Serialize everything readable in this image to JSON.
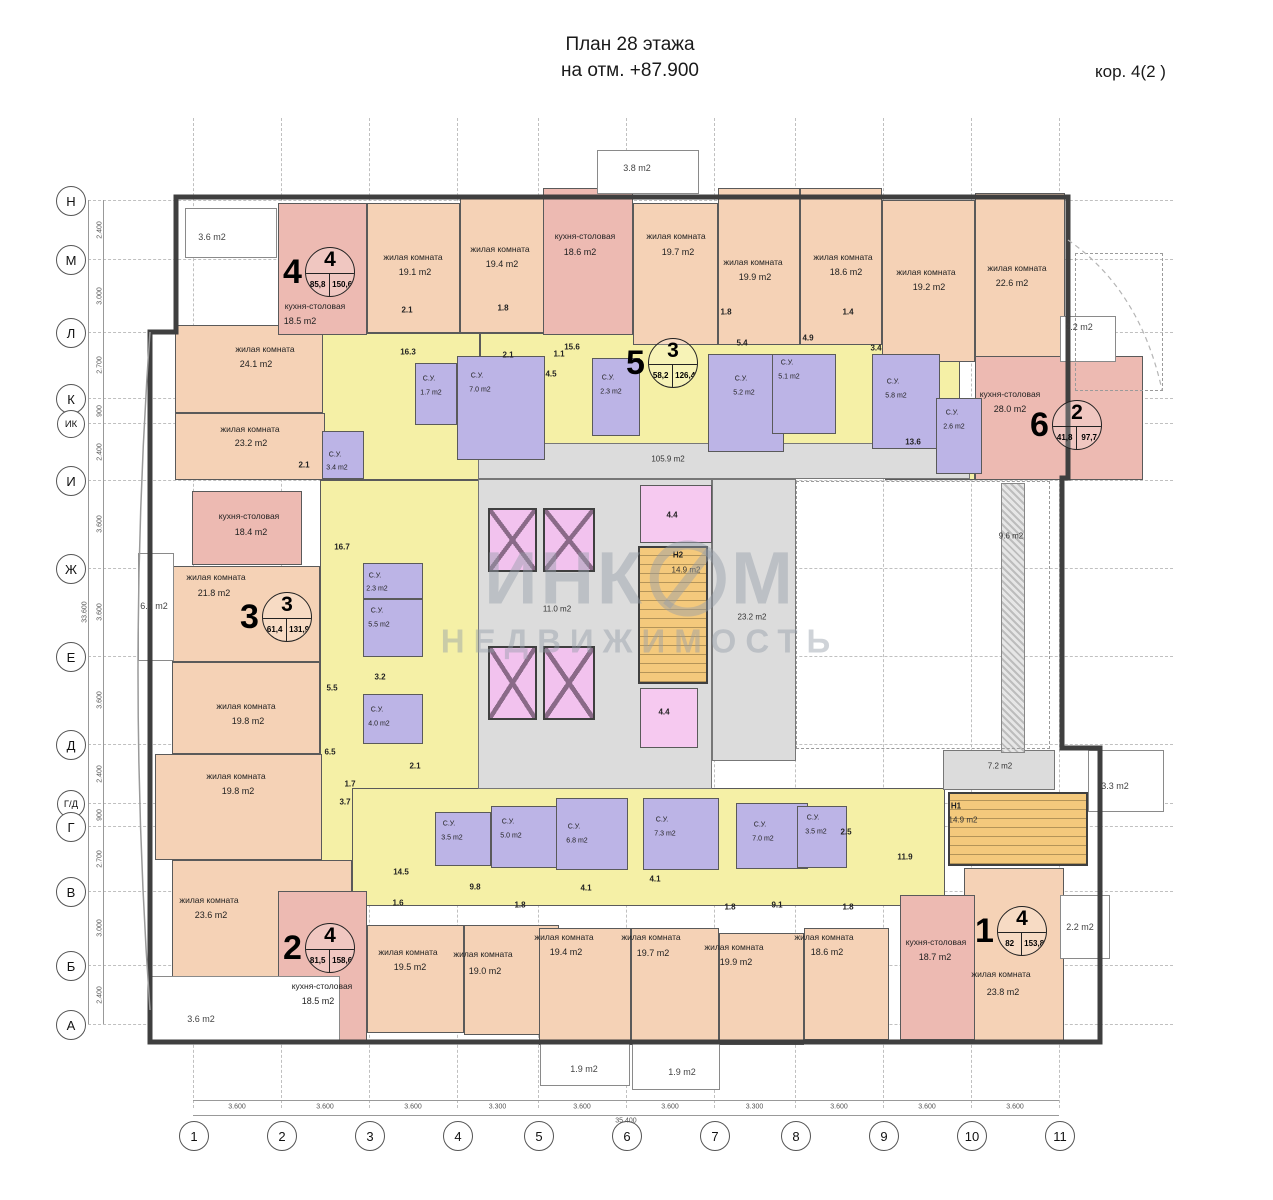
{
  "title": {
    "line1": "План 28 этажа",
    "line2": "на отм. +87.900",
    "corpus": "кор. 4(2 )"
  },
  "watermark": {
    "part1": "ИНК",
    "part2": "М",
    "line2": "НЕДВИЖИМОСТЬ"
  },
  "colors": {
    "living": "#f5d2b6",
    "kitchen": "#edbab2",
    "corridor": "#f5f0a6",
    "bathroom": "#bcb4e6",
    "elevator": "#f2c2ee",
    "stairs": "#f4c97c",
    "common": "#dcdcdc",
    "wall": "#3f3f3f"
  },
  "axes": {
    "rows": [
      {
        "label": "Н",
        "y": 200
      },
      {
        "label": "М",
        "y": 259
      },
      {
        "label": "Л",
        "y": 332
      },
      {
        "label": "К",
        "y": 398
      },
      {
        "label": "ИК",
        "y": 423,
        "small": true
      },
      {
        "label": "И",
        "y": 480
      },
      {
        "label": "Ж",
        "y": 568
      },
      {
        "label": "Е",
        "y": 656
      },
      {
        "label": "Д",
        "y": 744
      },
      {
        "label": "Г/Д",
        "y": 803,
        "small": true
      },
      {
        "label": "Г",
        "y": 826
      },
      {
        "label": "В",
        "y": 891
      },
      {
        "label": "Б",
        "y": 965
      },
      {
        "label": "А",
        "y": 1024
      }
    ],
    "cols": [
      {
        "label": "1",
        "x": 193
      },
      {
        "label": "2",
        "x": 281
      },
      {
        "label": "3",
        "x": 369
      },
      {
        "label": "4",
        "x": 457
      },
      {
        "label": "5",
        "x": 538
      },
      {
        "label": "6",
        "x": 626
      },
      {
        "label": "7",
        "x": 714
      },
      {
        "label": "8",
        "x": 795
      },
      {
        "label": "9",
        "x": 883
      },
      {
        "label": "10",
        "x": 971
      },
      {
        "label": "11",
        "x": 1059
      }
    ],
    "row_dims": [
      "2.400",
      "3.000",
      "2.700",
      "900",
      "2.400",
      "3.600",
      "3.600",
      "3.600",
      "2.400",
      "900",
      "2.700",
      "3.000",
      "2.400"
    ],
    "col_dims": [
      "3.600",
      "3.600",
      "3.600",
      "3.300",
      "3.600",
      "3.600",
      "3.300",
      "3.600",
      "3.600",
      "3.600"
    ],
    "total_width": "35.400",
    "total_height": "33.600"
  },
  "apartments": [
    {
      "n": "4",
      "r": "4",
      "a1": "85,8",
      "a2": "150,6",
      "x": 283,
      "y": 247
    },
    {
      "n": "5",
      "r": "3",
      "a1": "58,2",
      "a2": "126,4",
      "x": 626,
      "y": 338
    },
    {
      "n": "6",
      "r": "2",
      "a1": "41,8",
      "a2": "97,7",
      "x": 1030,
      "y": 400
    },
    {
      "n": "3",
      "r": "3",
      "a1": "61,4",
      "a2": "131,9",
      "x": 240,
      "y": 592
    },
    {
      "n": "2",
      "r": "4",
      "a1": "81,5",
      "a2": "158,6",
      "x": 283,
      "y": 923
    },
    {
      "n": "1",
      "r": "4",
      "a1": "82",
      "a2": "153,8",
      "x": 975,
      "y": 906
    }
  ],
  "rooms": [
    [
      "corr",
      320,
      333,
      160,
      147
    ],
    [
      "corr",
      480,
      333,
      480,
      112
    ],
    [
      "corr",
      885,
      416,
      90,
      64
    ],
    [
      "corr",
      320,
      480,
      160,
      400
    ],
    [
      "corr",
      352,
      788,
      593,
      118
    ],
    [
      "common",
      478,
      443,
      492,
      36
    ],
    [
      "common",
      478,
      479,
      234,
      310
    ],
    [
      "common",
      712,
      479,
      84,
      282
    ],
    [
      "common",
      943,
      750,
      112,
      40
    ],
    [
      "hatch",
      1001,
      483,
      24,
      270
    ],
    [
      "living",
      367,
      203,
      93,
      130
    ],
    [
      "living",
      460,
      196,
      85,
      137
    ],
    [
      "living",
      633,
      203,
      85,
      142
    ],
    [
      "living",
      718,
      188,
      82,
      157
    ],
    [
      "living",
      800,
      188,
      82,
      157
    ],
    [
      "living",
      882,
      200,
      93,
      162
    ],
    [
      "living",
      975,
      193,
      90,
      170
    ],
    [
      "living",
      175,
      325,
      148,
      88
    ],
    [
      "living",
      175,
      413,
      150,
      67
    ],
    [
      "living",
      172,
      566,
      148,
      96
    ],
    [
      "living",
      172,
      662,
      148,
      92
    ],
    [
      "living",
      155,
      754,
      167,
      106
    ],
    [
      "living",
      172,
      860,
      180,
      120
    ],
    [
      "living",
      367,
      925,
      97,
      108
    ],
    [
      "living",
      464,
      925,
      95,
      110
    ],
    [
      "living",
      539,
      928,
      92,
      117
    ],
    [
      "living",
      631,
      928,
      88,
      117
    ],
    [
      "living",
      719,
      933,
      85,
      112
    ],
    [
      "living",
      804,
      928,
      85,
      112
    ],
    [
      "living",
      964,
      868,
      100,
      174
    ],
    [
      "kitchen",
      278,
      203,
      89,
      132
    ],
    [
      "kitchen",
      543,
      188,
      90,
      147
    ],
    [
      "kitchen",
      192,
      491,
      110,
      74
    ],
    [
      "kitchen",
      975,
      356,
      168,
      124
    ],
    [
      "kitchen",
      278,
      891,
      89,
      152
    ],
    [
      "kitchen",
      900,
      895,
      75,
      145
    ],
    [
      "bath",
      415,
      363,
      42,
      62
    ],
    [
      "bath",
      457,
      356,
      88,
      104
    ],
    [
      "bath",
      592,
      358,
      48,
      78
    ],
    [
      "bath",
      708,
      354,
      76,
      98
    ],
    [
      "bath",
      772,
      354,
      64,
      80
    ],
    [
      "bath",
      872,
      354,
      68,
      95
    ],
    [
      "bath",
      936,
      398,
      46,
      76
    ],
    [
      "bath",
      363,
      563,
      60,
      36
    ],
    [
      "bath",
      363,
      599,
      60,
      58
    ],
    [
      "bath",
      363,
      694,
      60,
      50
    ],
    [
      "bath",
      322,
      431,
      42,
      48
    ],
    [
      "bath",
      435,
      812,
      56,
      54
    ],
    [
      "bath",
      491,
      806,
      72,
      62
    ],
    [
      "bath",
      556,
      798,
      72,
      72
    ],
    [
      "bath",
      643,
      798,
      76,
      72
    ],
    [
      "bath",
      736,
      803,
      72,
      66
    ],
    [
      "bath",
      797,
      806,
      50,
      62
    ],
    [
      "lift",
      488,
      508,
      49,
      64
    ],
    [
      "lift",
      543,
      508,
      52,
      64
    ],
    [
      "lift",
      488,
      646,
      49,
      74
    ],
    [
      "lift",
      543,
      646,
      52,
      74
    ],
    [
      "stair",
      638,
      546,
      70,
      138
    ],
    [
      "stair",
      948,
      792,
      140,
      74
    ],
    [
      "lobby",
      640,
      485,
      72,
      58
    ],
    [
      "lobby",
      640,
      688,
      58,
      60
    ],
    [
      "balcony",
      185,
      208,
      92,
      50
    ],
    [
      "balcony",
      597,
      150,
      102,
      44
    ],
    [
      "balcony",
      1060,
      316,
      56,
      46
    ],
    [
      "balcony",
      138,
      553,
      36,
      108
    ],
    [
      "balcony",
      148,
      976,
      192,
      68
    ],
    [
      "balcony",
      540,
      1042,
      90,
      44
    ],
    [
      "balcony",
      632,
      1042,
      88,
      48
    ],
    [
      "balcony",
      1060,
      895,
      50,
      64
    ],
    [
      "balcony",
      1088,
      750,
      76,
      62
    ],
    [
      "void",
      796,
      481,
      254,
      268
    ],
    [
      "void",
      1075,
      253,
      88,
      138
    ]
  ],
  "labels": [
    [
      "жилая комната",
      413,
      257,
      "n"
    ],
    [
      "19.1 m2",
      415,
      272,
      "a"
    ],
    [
      "жилая комната",
      500,
      249,
      "n"
    ],
    [
      "19.4 m2",
      502,
      264,
      "a"
    ],
    [
      "кухня-столовая",
      585,
      236,
      "n"
    ],
    [
      "18.6 m2",
      580,
      252,
      "a"
    ],
    [
      "жилая комната",
      676,
      236,
      "n"
    ],
    [
      "19.7 m2",
      678,
      252,
      "a"
    ],
    [
      "жилая комната",
      753,
      262,
      "n"
    ],
    [
      "19.9 m2",
      755,
      277,
      "a"
    ],
    [
      "жилая комната",
      843,
      257,
      "n"
    ],
    [
      "18.6 m2",
      846,
      272,
      "a"
    ],
    [
      "жилая комната",
      926,
      272,
      "n"
    ],
    [
      "19.2 m2",
      929,
      287,
      "a"
    ],
    [
      "жилая комната",
      1017,
      268,
      "n"
    ],
    [
      "22.6 m2",
      1012,
      283,
      "a"
    ],
    [
      "кухня-столовая",
      315,
      306,
      "n"
    ],
    [
      "18.5 m2",
      300,
      321,
      "a"
    ],
    [
      "жилая комната",
      265,
      349,
      "n"
    ],
    [
      "24.1 m2",
      256,
      364,
      "a"
    ],
    [
      "жилая комната",
      250,
      429,
      "n"
    ],
    [
      "23.2 m2",
      251,
      443,
      "a"
    ],
    [
      "кухня-столовая",
      249,
      516,
      "n"
    ],
    [
      "18.4 m2",
      251,
      532,
      "a"
    ],
    [
      "жилая комната",
      216,
      577,
      "n"
    ],
    [
      "21.8 m2",
      214,
      593,
      "a"
    ],
    [
      "жилая комната",
      246,
      706,
      "n"
    ],
    [
      "19.8 m2",
      248,
      721,
      "a"
    ],
    [
      "жилая комната",
      236,
      776,
      "n"
    ],
    [
      "19.8 m2",
      238,
      791,
      "a"
    ],
    [
      "жилая комната",
      209,
      900,
      "n"
    ],
    [
      "23.6 m2",
      211,
      915,
      "a"
    ],
    [
      "кухня-столовая",
      322,
      986,
      "n"
    ],
    [
      "18.5 m2",
      318,
      1001,
      "a"
    ],
    [
      "жилая комната",
      408,
      952,
      "n"
    ],
    [
      "19.5 m2",
      410,
      967,
      "a"
    ],
    [
      "жилая комната",
      483,
      954,
      "n"
    ],
    [
      "19.0 m2",
      485,
      971,
      "a"
    ],
    [
      "жилая комната",
      564,
      937,
      "n"
    ],
    [
      "19.4 m2",
      566,
      952,
      "a"
    ],
    [
      "жилая комната",
      651,
      937,
      "n"
    ],
    [
      "19.7 m2",
      653,
      953,
      "a"
    ],
    [
      "жилая комната",
      734,
      947,
      "n"
    ],
    [
      "19.9 m2",
      736,
      962,
      "a"
    ],
    [
      "жилая комната",
      824,
      937,
      "n"
    ],
    [
      "18.6 m2",
      827,
      952,
      "a"
    ],
    [
      "кухня-столовая",
      936,
      942,
      "n"
    ],
    [
      "18.7 m2",
      935,
      957,
      "a"
    ],
    [
      "жилая комната",
      1001,
      974,
      "n"
    ],
    [
      "23.8 m2",
      1003,
      992,
      "a"
    ],
    [
      "кухня-столовая",
      1010,
      394,
      "n"
    ],
    [
      "28.0 m2",
      1010,
      409,
      "a"
    ],
    [
      "С.У.",
      477,
      376,
      "s"
    ],
    [
      "7.0 m2",
      480,
      390,
      "s"
    ],
    [
      "С.У.",
      429,
      379,
      "s"
    ],
    [
      "1.7 m2",
      431,
      393,
      "s"
    ],
    [
      "С.У.",
      608,
      378,
      "s"
    ],
    [
      "2.3 m2",
      611,
      392,
      "s"
    ],
    [
      "С.У.",
      741,
      379,
      "s"
    ],
    [
      "5.2 m2",
      744,
      393,
      "s"
    ],
    [
      "С.У.",
      787,
      363,
      "s"
    ],
    [
      "5.1 m2",
      789,
      377,
      "s"
    ],
    [
      "С.У.",
      893,
      382,
      "s"
    ],
    [
      "5.8 m2",
      896,
      396,
      "s"
    ],
    [
      "С.У.",
      952,
      413,
      "s"
    ],
    [
      "2.6 m2",
      954,
      427,
      "s"
    ],
    [
      "С.У.",
      375,
      576,
      "s"
    ],
    [
      "2.3 m2",
      377,
      589,
      "s"
    ],
    [
      "С.У.",
      377,
      611,
      "s"
    ],
    [
      "5.5 m2",
      379,
      625,
      "s"
    ],
    [
      "С.У.",
      377,
      710,
      "s"
    ],
    [
      "4.0 m2",
      379,
      724,
      "s"
    ],
    [
      "С.У.",
      335,
      455,
      "s"
    ],
    [
      "3.4 m2",
      337,
      468,
      "s"
    ],
    [
      "С.У.",
      449,
      824,
      "s"
    ],
    [
      "3.5 m2",
      452,
      838,
      "s"
    ],
    [
      "С.У.",
      508,
      822,
      "s"
    ],
    [
      "5.0 m2",
      511,
      836,
      "s"
    ],
    [
      "С.У.",
      574,
      827,
      "s"
    ],
    [
      "6.8 m2",
      577,
      841,
      "s"
    ],
    [
      "С.У.",
      662,
      820,
      "s"
    ],
    [
      "7.3 m2",
      665,
      834,
      "s"
    ],
    [
      "С.У.",
      760,
      825,
      "s"
    ],
    [
      "7.0 m2",
      763,
      839,
      "s"
    ],
    [
      "С.У.",
      813,
      818,
      "s"
    ],
    [
      "3.5 m2",
      816,
      832,
      "s"
    ],
    [
      "16.3",
      408,
      352,
      "b"
    ],
    [
      "15.6",
      572,
      347,
      "b"
    ],
    [
      "1.1",
      559,
      354,
      "b"
    ],
    [
      "4.5",
      551,
      374,
      "b"
    ],
    [
      "2.1",
      508,
      355,
      "b"
    ],
    [
      "2.1",
      407,
      310,
      "b"
    ],
    [
      "1.8",
      503,
      308,
      "b"
    ],
    [
      "5.4",
      742,
      343,
      "b"
    ],
    [
      "4.9",
      808,
      338,
      "b"
    ],
    [
      "3.4",
      876,
      348,
      "b"
    ],
    [
      "1.8",
      726,
      312,
      "b"
    ],
    [
      "1.4",
      848,
      312,
      "b"
    ],
    [
      "13.6",
      913,
      442,
      "b"
    ],
    [
      "16.7",
      342,
      547,
      "b"
    ],
    [
      "5.5",
      332,
      688,
      "b"
    ],
    [
      "3.2",
      380,
      677,
      "b"
    ],
    [
      "6.5",
      330,
      752,
      "b"
    ],
    [
      "2.1",
      415,
      766,
      "b"
    ],
    [
      "1.7",
      350,
      784,
      "b"
    ],
    [
      "3.7",
      345,
      802,
      "b"
    ],
    [
      "2.1",
      304,
      465,
      "b"
    ],
    [
      "14.5",
      401,
      872,
      "b"
    ],
    [
      "9.8",
      475,
      887,
      "b"
    ],
    [
      "1.6",
      398,
      903,
      "b"
    ],
    [
      "1.8",
      520,
      905,
      "b"
    ],
    [
      "4.1",
      586,
      888,
      "b"
    ],
    [
      "4.1",
      655,
      879,
      "b"
    ],
    [
      "1.8",
      730,
      907,
      "b"
    ],
    [
      "9.1",
      777,
      905,
      "b"
    ],
    [
      "1.8",
      848,
      907,
      "b"
    ],
    [
      "2.5",
      846,
      832,
      "b"
    ],
    [
      "11.9",
      905,
      857,
      "b"
    ],
    [
      "4.4",
      672,
      515,
      "b"
    ],
    [
      "4.4",
      664,
      712,
      "b"
    ],
    [
      "105.9 m2",
      668,
      459,
      "c"
    ],
    [
      "11.0 m2",
      557,
      609,
      "c"
    ],
    [
      "23.2 m2",
      752,
      617,
      "c"
    ],
    [
      "9.6 m2",
      1011,
      536,
      "c"
    ],
    [
      "7.2 m2",
      1000,
      766,
      "c"
    ],
    [
      "Н2",
      678,
      555,
      "b"
    ],
    [
      "14.9 m2",
      686,
      570,
      "c"
    ],
    [
      "Н1",
      956,
      806,
      "b"
    ],
    [
      "14.9 m2",
      963,
      820,
      "c"
    ],
    [
      "3.6 m2",
      212,
      237,
      "g"
    ],
    [
      "3.8 m2",
      637,
      168,
      "g"
    ],
    [
      "2.2 m2",
      1079,
      327,
      "g"
    ],
    [
      "6.7 m2",
      154,
      606,
      "g"
    ],
    [
      "3.6 m2",
      201,
      1019,
      "g"
    ],
    [
      "1.9 m2",
      584,
      1069,
      "g"
    ],
    [
      "1.9 m2",
      682,
      1072,
      "g"
    ],
    [
      "2.2 m2",
      1080,
      927,
      "g"
    ],
    [
      "3.3 m2",
      1115,
      786,
      "g"
    ]
  ]
}
